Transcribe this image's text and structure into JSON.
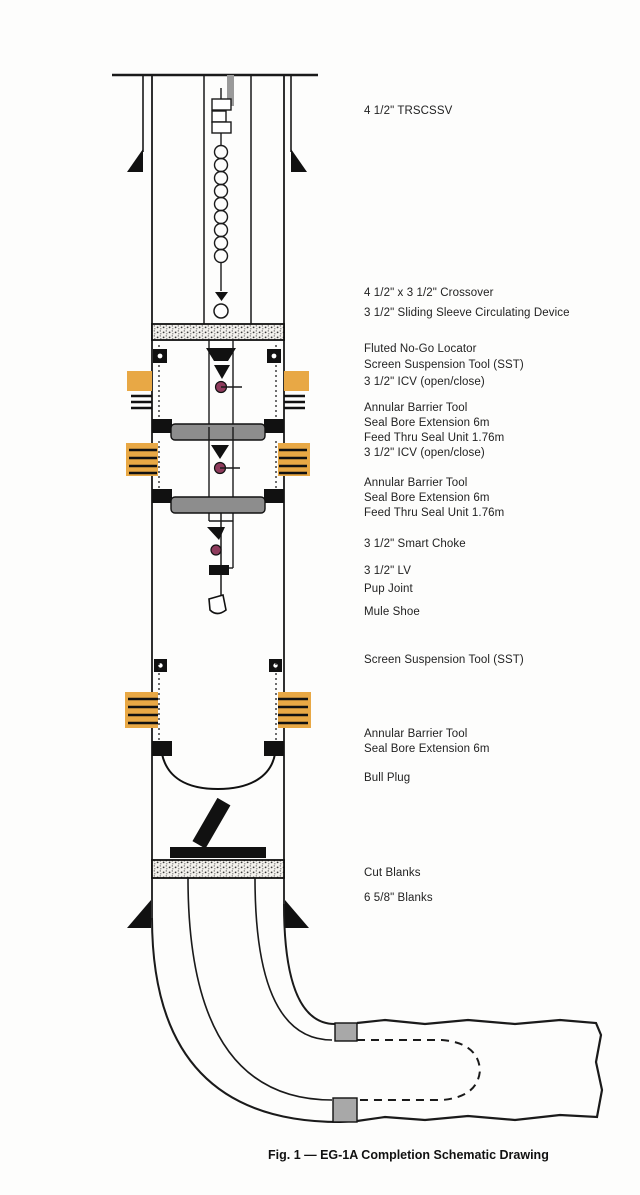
{
  "figure": {
    "caption": "Fig. 1 — EG-1A Completion Schematic Drawing"
  },
  "labels": [
    {
      "text": "4 1/2\" TRSCSSV"
    },
    {
      "text": "4 1/2\" x 3 1/2\" Crossover"
    },
    {
      "text": "3 1/2\" Sliding Sleeve Circulating Device"
    },
    {
      "text": "Fluted No-Go Locator"
    },
    {
      "text": "Screen Suspension Tool (SST)"
    },
    {
      "text": "3 1/2\" ICV (open/close)"
    },
    {
      "text": "Annular Barrier Tool"
    },
    {
      "text": "Seal Bore Extension 6m"
    },
    {
      "text": "Feed Thru Seal Unit 1.76m"
    },
    {
      "text": "3 1/2\" ICV (open/close)"
    },
    {
      "text": "Annular Barrier Tool"
    },
    {
      "text": "Seal Bore Extension 6m"
    },
    {
      "text": "Feed Thru Seal Unit 1.76m"
    },
    {
      "text": "3 1/2\" Smart Choke"
    },
    {
      "text": "3 1/2\" LV"
    },
    {
      "text": "Pup Joint"
    },
    {
      "text": "Mule Shoe"
    },
    {
      "text": "Screen Suspension Tool (SST)"
    },
    {
      "text": "Annular Barrier Tool"
    },
    {
      "text": "Seal Bore Extension 6m"
    },
    {
      "text": "Bull Plug"
    },
    {
      "text": "Cut Blanks"
    },
    {
      "text": "6 5/8\" Blanks"
    }
  ],
  "colors": {
    "line": "#1a1a1a",
    "screen_orange": "#e8a845",
    "seal_bore_gray": "#8d8d8d",
    "liner_hanger_gray": "#a8a8a8",
    "icv_maroon": "#8e3b5c"
  }
}
